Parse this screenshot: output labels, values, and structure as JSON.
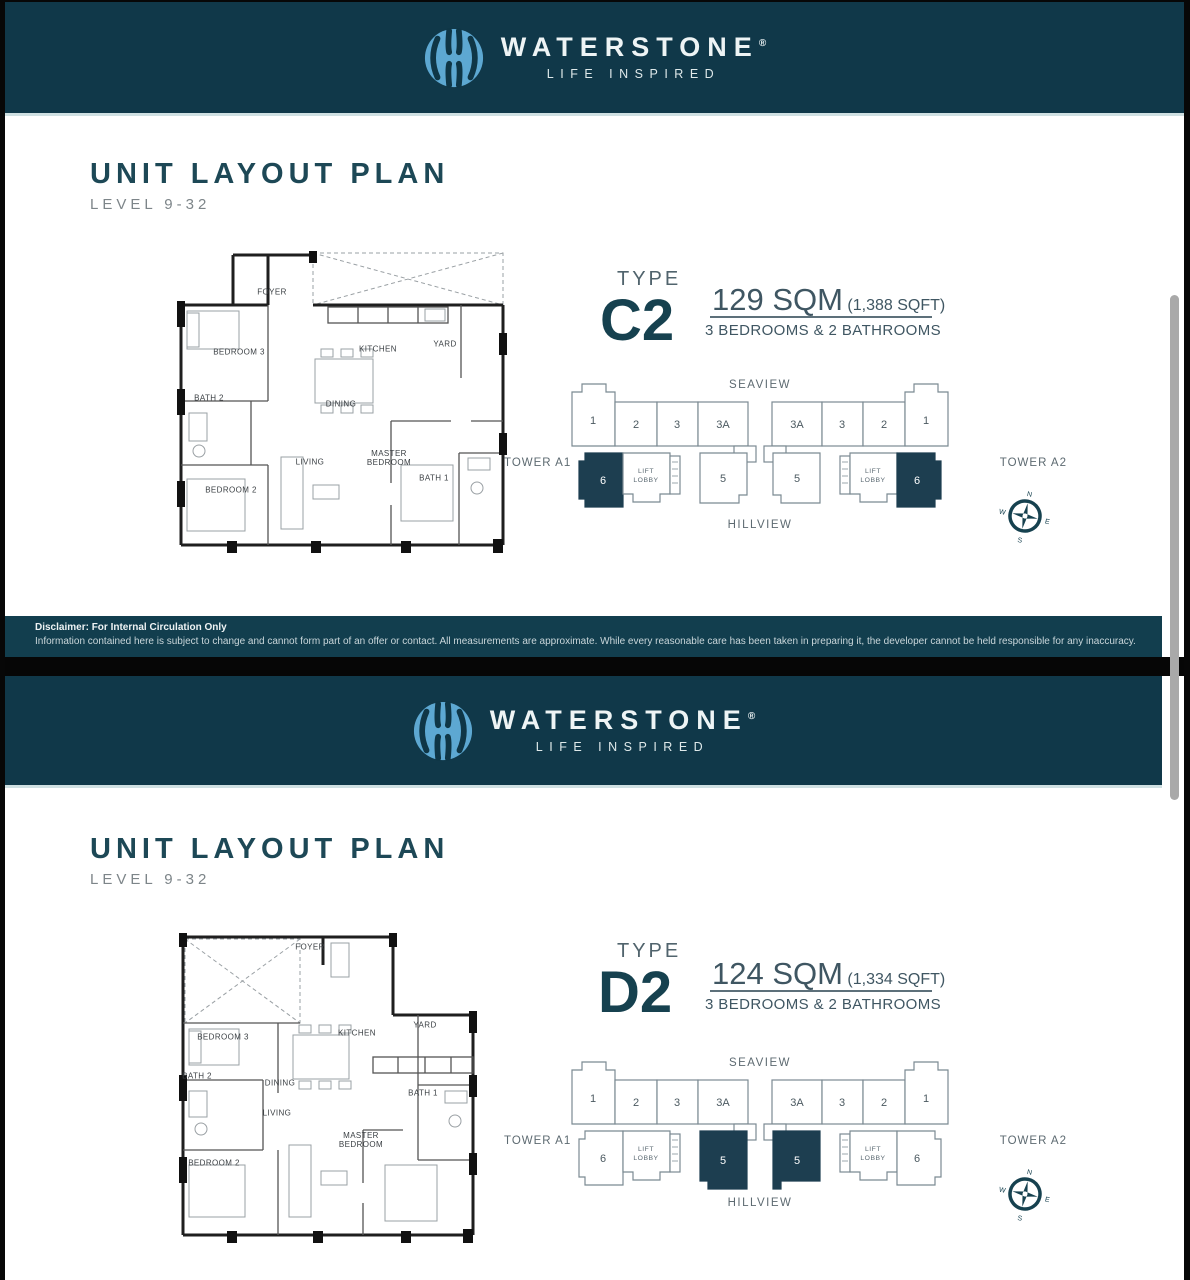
{
  "colors": {
    "header_teal": "#103849",
    "disclaimer_teal": "#123e4e",
    "accent_dark_teal": "#16414f",
    "highlight_unit": "#1d3e50",
    "logo_blue": "#5da8d2"
  },
  "page1": {
    "header": {
      "brand": "WATERSTONE",
      "registered": "®",
      "tagline": "LIFE INSPIRED"
    },
    "title": "UNIT LAYOUT PLAN",
    "subtitle": "LEVEL 9-32",
    "type_label": "TYPE",
    "type_code": "C2",
    "area_sqm": "129 SQM",
    "area_sqft": "(1,388 SQFT)",
    "rooms_line": "3 BEDROOMS & 2 BATHROOMS",
    "floorplan": {
      "rooms": [
        "FOYER",
        "KITCHEN",
        "YARD",
        "BEDROOM 3",
        "BATH 2",
        "DINING",
        "LIVING",
        "MASTER BEDROOM",
        "BATH 1",
        "BEDROOM 2"
      ]
    },
    "keyplan": {
      "seaview": "SEAVIEW",
      "hillview": "HILLVIEW",
      "tower_a1": "TOWER A1",
      "tower_a2": "TOWER A2",
      "lift_line1": "LIFT",
      "lift_line2": "LOBBY",
      "left_top": [
        "1",
        "2",
        "3",
        "3A"
      ],
      "right_top": [
        "3A",
        "3",
        "2",
        "1"
      ],
      "left_bottom": [
        "6",
        "5"
      ],
      "right_bottom": [
        "5",
        "6"
      ],
      "highlighted_unit": "6",
      "compass": {
        "n": "N",
        "e": "E",
        "s": "S",
        "w": "W"
      }
    },
    "disclaimer_title": "Disclaimer: For Internal Circulation Only",
    "disclaimer_body": "Information contained here is subject to change and cannot form part of an offer or contact. All measurements are approximate. While every reasonable care has been taken in preparing it, the developer cannot be held responsible for any inaccuracy."
  },
  "page2": {
    "header": {
      "brand": "WATERSTONE",
      "registered": "®",
      "tagline": "LIFE INSPIRED"
    },
    "title": "UNIT LAYOUT PLAN",
    "subtitle": "LEVEL 9-32",
    "type_label": "TYPE",
    "type_code": "D2",
    "area_sqm": "124 SQM",
    "area_sqft": "(1,334 SQFT)",
    "rooms_line": "3 BEDROOMS & 2 BATHROOMS",
    "floorplan": {
      "rooms": [
        "FOYER",
        "KITCHEN",
        "YARD",
        "BEDROOM 3",
        "BATH 2",
        "DINING",
        "LIVING",
        "MASTER BEDROOM",
        "BATH 1",
        "BEDROOM 2"
      ]
    },
    "keyplan": {
      "seaview": "SEAVIEW",
      "hillview": "HILLVIEW",
      "tower_a1": "TOWER A1",
      "tower_a2": "TOWER A2",
      "lift_line1": "LIFT",
      "lift_line2": "LOBBY",
      "left_top": [
        "1",
        "2",
        "3",
        "3A"
      ],
      "right_top": [
        "3A",
        "3",
        "2",
        "1"
      ],
      "left_bottom": [
        "6",
        "5"
      ],
      "right_bottom": [
        "5",
        "6"
      ],
      "highlighted_unit": "5",
      "compass": {
        "n": "N",
        "e": "E",
        "s": "S",
        "w": "W"
      }
    }
  }
}
